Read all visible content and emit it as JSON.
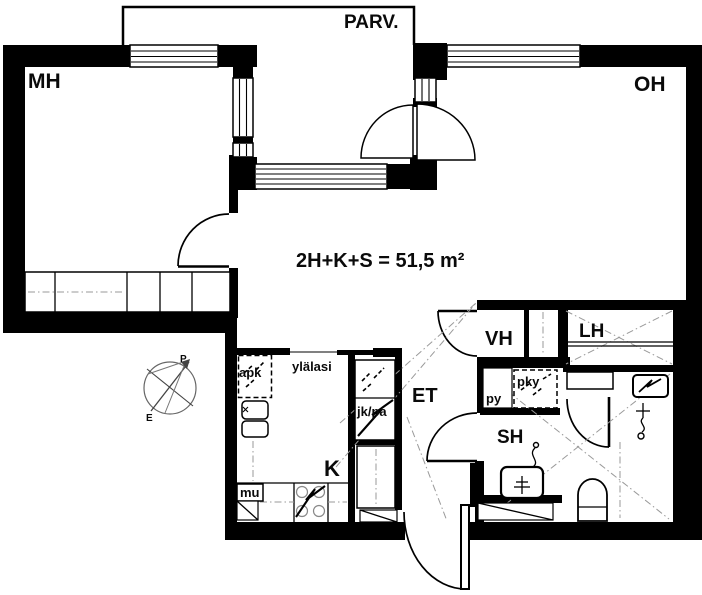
{
  "plan": {
    "area_label": "2H+K+S = 51,5 m²",
    "rooms": {
      "balcony": "PARV.",
      "bedroom": "MH",
      "living_room": "OH",
      "kitchen": "K",
      "hallway": "ET",
      "walk_in_closet": "VH",
      "sauna": "LH",
      "bathroom": "SH"
    },
    "fixtures": {
      "dishwasher": "apk",
      "upper_glass": "ylälasi",
      "fridge_freezer": "jk/pa",
      "drying_cabinet": "pky",
      "washing_machine": "py",
      "masonry": "mu"
    },
    "compass": {
      "north": "P",
      "south": "E"
    },
    "colors": {
      "wall": "#000000",
      "background": "#ffffff",
      "guide_dash": "#9a9a9a"
    }
  }
}
